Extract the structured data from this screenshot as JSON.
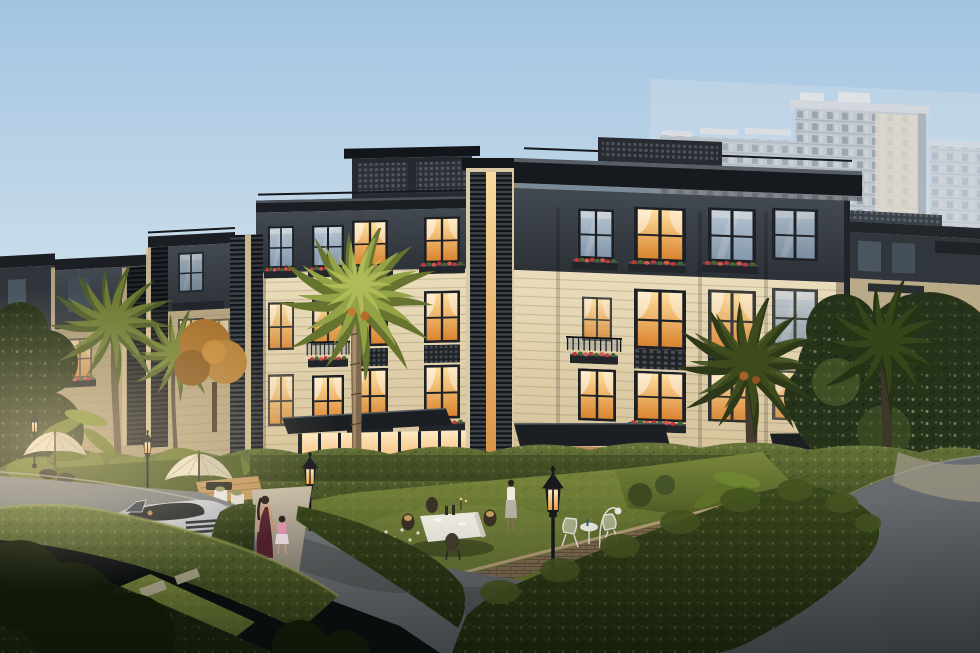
{
  "scene": {
    "type": "architectural-exterior-rendering",
    "description": "Dusk rendering of a modern oriental-style villa compound: a row of four-storey cream-and-charcoal townhouses with warmly lit windows and flower boxes, front gardens with parasols, dining tables and lantern street lamps, palm trees, a silver convertible sports car on a curving street, a woman walking with a child, and high-rise apartment towers in the hazy background",
    "time_of_day": "dusk",
    "palette": {
      "sky_top": "#a3c4e1",
      "sky_mid": "#c8dcea",
      "sky_horizon": "#e7e8e7",
      "horizon_pink": "#eedcd4",
      "facade_cream": "#eaddbb",
      "facade_shadow": "#d2bf96",
      "roof_charcoal": "#2c3137",
      "trim_dark": "#1b1f24",
      "window_warm": "#f6b565",
      "window_warm_deep": "#d9842f",
      "window_cool": "#b5c4d2",
      "flower_red": "#c23a37",
      "hedge_light": "#67753a",
      "hedge_mid": "#333f18",
      "hedge_dark": "#1d280e",
      "lawn": "#4c5a24",
      "lawn_lit": "#79873c",
      "road_light": "#8a8c8e",
      "road_dark": "#4b4f55",
      "path_tan": "#c0b49c",
      "car_silver": "#b3b9bf",
      "taillight_red": "#c52c28",
      "umbrella_cream": "#ebe2c9",
      "lamp_black": "#17191d",
      "lamp_glow": "#ffc670",
      "brick_wall": "#82704f",
      "palm_lit": "#94a345",
      "palm_dark": "#2c3818",
      "tower_gray": "#b7bec6",
      "tower_cream": "#d7d0c0",
      "tree_dark": "#26331a"
    },
    "objects": [
      {
        "name": "high-rise-towers",
        "label": "background apartment towers"
      },
      {
        "name": "villa-row-main",
        "label": "four-storey villa townhouses with lit windows"
      },
      {
        "name": "villa-row-left",
        "label": "neighbouring villas in shadow"
      },
      {
        "name": "palm-trees",
        "label": "palm trees"
      },
      {
        "name": "gardens",
        "label": "front gardens with dining set, wire chairs, parasols and flower beds"
      },
      {
        "name": "street-lamps",
        "label": "black lantern street lamps"
      },
      {
        "name": "sports-car",
        "label": "silver convertible sports car"
      },
      {
        "name": "pedestrians",
        "label": "woman walking with a child"
      },
      {
        "name": "road",
        "label": "curving asphalt street"
      }
    ]
  }
}
